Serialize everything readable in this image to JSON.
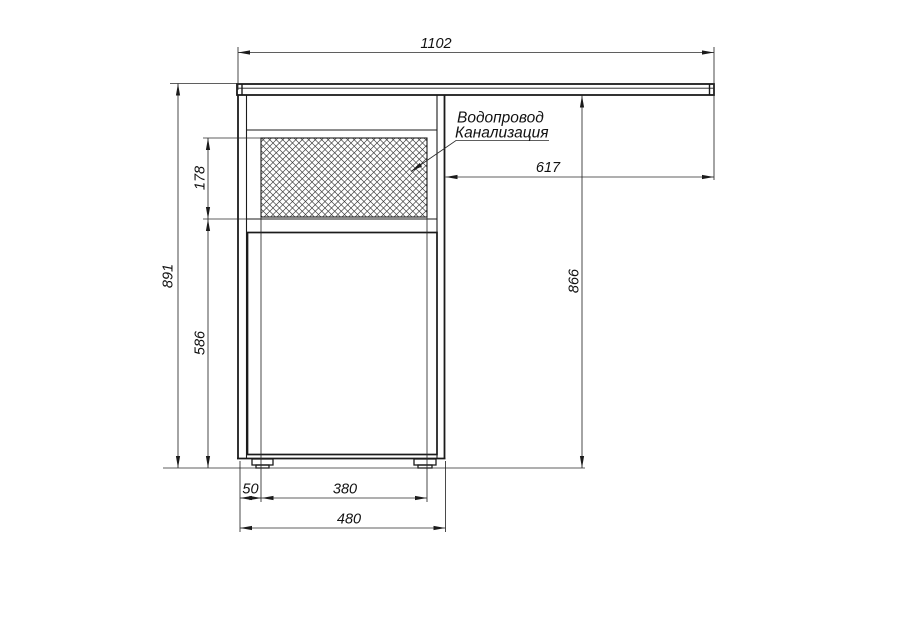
{
  "drawing": {
    "type": "cabinet-elevation-technical-drawing",
    "labels": {
      "utilities_line1": "Водопровод",
      "utilities_line2": "Канализация"
    },
    "dimensions": {
      "countertop_width": "1102",
      "countertop_overhang": "617",
      "underside_height": "866",
      "overall_height": "891",
      "niche_height": "178",
      "door_height": "586",
      "foot_inset": "50",
      "feet_span": "380",
      "cabinet_width": "480"
    },
    "colors": {
      "outline": "#1b1b1b",
      "dimension_lines": "#2a2a2a",
      "background": "#ffffff"
    }
  }
}
